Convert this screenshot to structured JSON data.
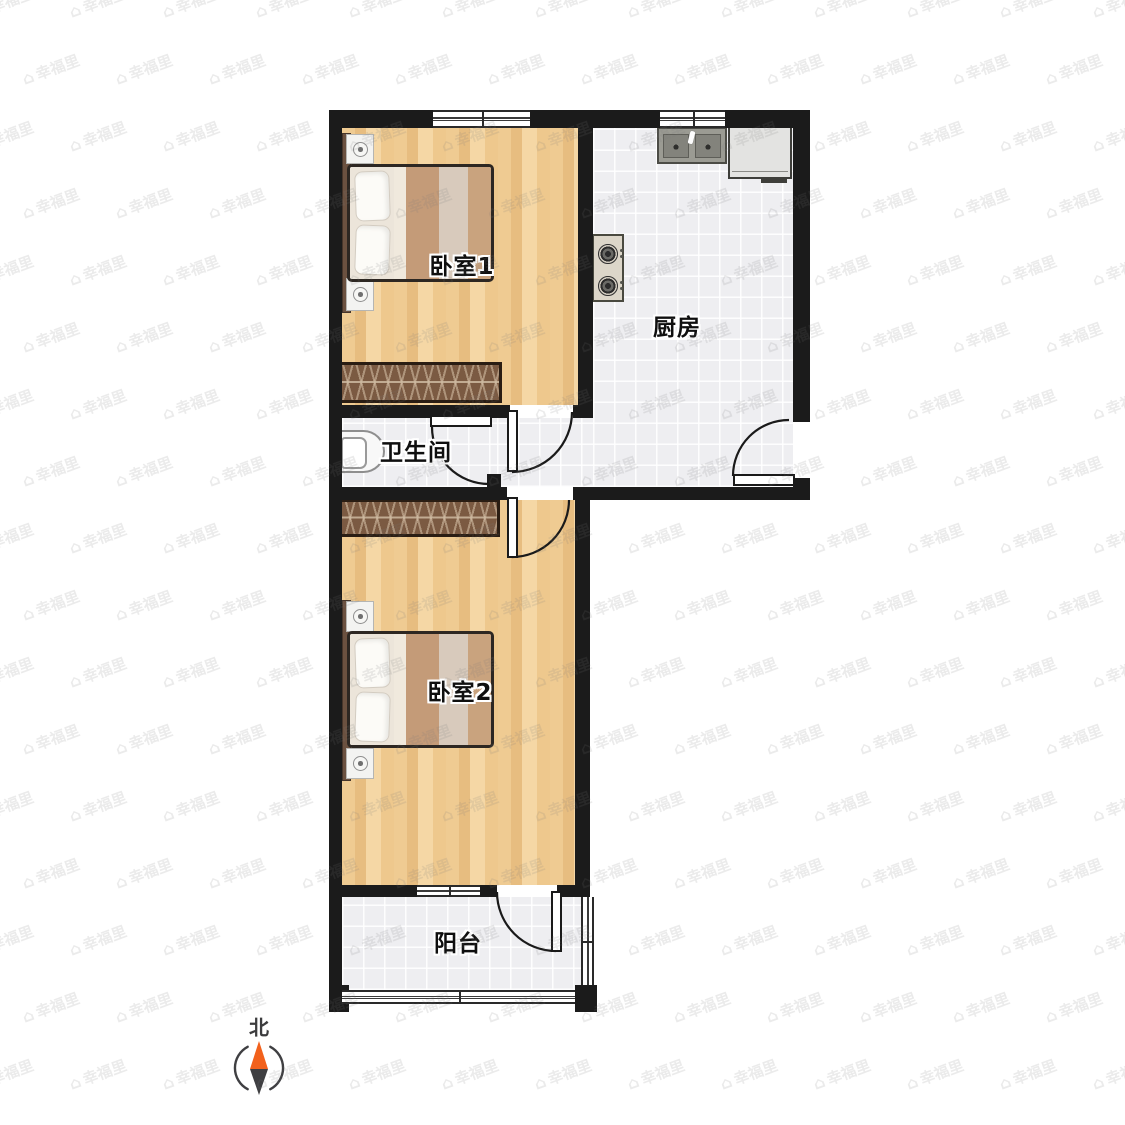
{
  "plan": {
    "type": "apartment-floorplan",
    "rooms": [
      {
        "id": "bedroom-1",
        "label": "卧室1",
        "floor": "wood"
      },
      {
        "id": "kitchen",
        "label": "厨房",
        "floor": "tile"
      },
      {
        "id": "bathroom",
        "label": "卫生间",
        "floor": "tile"
      },
      {
        "id": "bedroom-2",
        "label": "卧室2",
        "floor": "wood"
      },
      {
        "id": "balcony",
        "label": "阳台",
        "floor": "tile"
      }
    ],
    "furniture": [
      {
        "room": "bedroom-1",
        "items": [
          "double-bed",
          "nightstand",
          "nightstand",
          "wardrobe"
        ]
      },
      {
        "room": "kitchen",
        "items": [
          "double-basin-sink",
          "fridge-cabinet",
          "gas-stove"
        ]
      },
      {
        "room": "bathroom",
        "items": [
          "toilet"
        ]
      },
      {
        "room": "bedroom-2",
        "items": [
          "double-bed",
          "nightstand",
          "nightstand",
          "wardrobe"
        ]
      }
    ],
    "compass": {
      "label": "北",
      "north_color": "#f2611c",
      "south_color": "#3f3f42"
    },
    "watermark": {
      "text": "幸福里",
      "icon": "house-icon",
      "color": "rgba(122,122,122,0.15)"
    },
    "colors": {
      "wall": "#1b1b1b",
      "wood_floor": "#f0cd96",
      "tile_floor": "#eeeef1",
      "wardrobe": "#7b5a42",
      "label_text": "#0f0f0f"
    }
  }
}
